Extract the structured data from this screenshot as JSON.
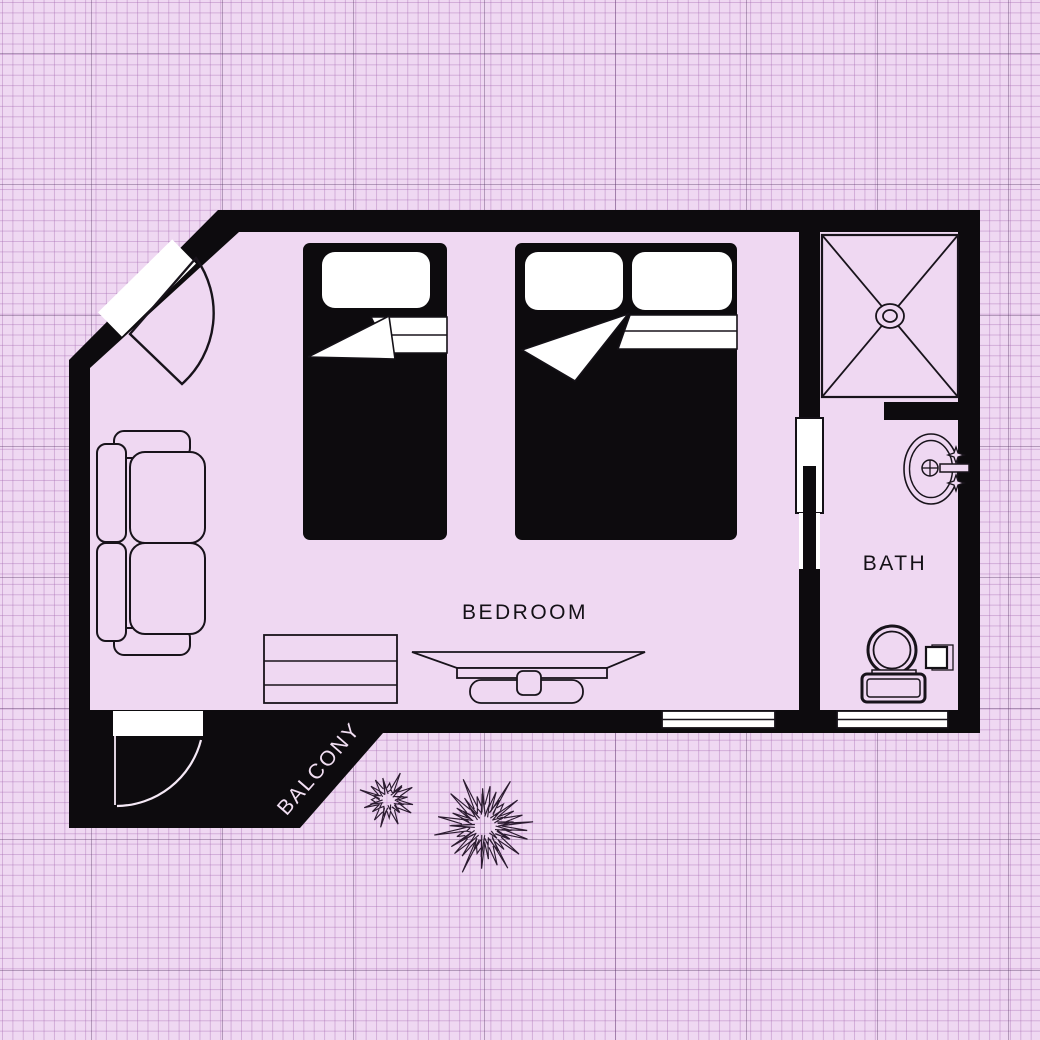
{
  "page": {
    "type": "apartment-floor-plan",
    "style": "pink-blueprint-graph-paper"
  },
  "rooms": {
    "bedroom": {
      "label": "BEDROOM"
    },
    "bath": {
      "label": "BATH"
    },
    "balcony": {
      "label": "BALCONY"
    }
  },
  "furniture": [
    "single-bed",
    "double-bed",
    "sofa",
    "dresser",
    "tv-console",
    "shower",
    "sink",
    "toilet",
    "paper-holder",
    "entry-door",
    "bath-door",
    "balcony-door",
    "window",
    "window",
    "plant-small",
    "plant-large"
  ],
  "colors": {
    "background": "#efd8f2",
    "grid_minor": "#ddbfe3",
    "grid_major": "#a48cb0",
    "walls": "#0d0b0e",
    "floor": "#efd8f2",
    "line": "#18131b",
    "white": "#ffffff",
    "label_dark": "#141117",
    "label_light": "#f2dff3"
  }
}
